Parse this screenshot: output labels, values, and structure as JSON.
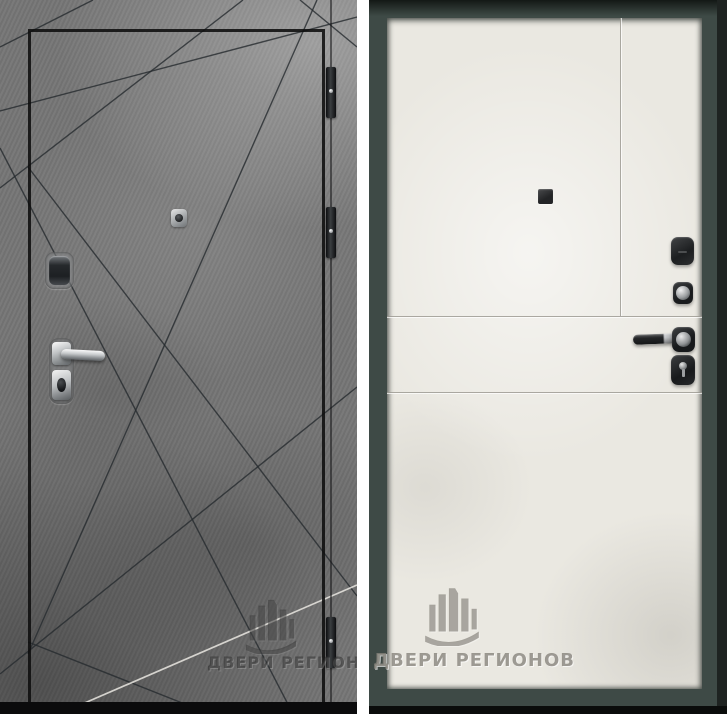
{
  "image": {
    "type": "product-photo",
    "subject": "steel entrance door, exterior and interior sides shown side by side"
  },
  "watermark": {
    "brand_text": "ДВЕРИ РЕГИОНОВ",
    "logo": "buildings-with-arc-logo"
  },
  "panels": {
    "left": {
      "name": "door-exterior-side",
      "finish": "gray concrete with diagonal ray grooves",
      "watermark_text": "ДВЕРИ РЕГИОНОВ",
      "hardware": [
        "peephole",
        "lock-cover",
        "lever-handle",
        "cylinder-lock",
        "hinge",
        "hinge",
        "hinge"
      ]
    },
    "right": {
      "name": "door-interior-side",
      "finish": "off-white panel with horizontal and vertical grooves, dark slate frame",
      "watermark_text": "ДВЕРИ РЕГИОНОВ",
      "hardware": [
        "peephole",
        "lock-cover",
        "turn-knob",
        "lever-handle",
        "keyhole-escutcheon"
      ]
    }
  },
  "colors": {
    "concrete_gray": "#757575",
    "groove_dark": "#2b2f33",
    "panel_offwhite": "#eae8e1",
    "frame_slate": "#3e4a46",
    "hardware_chrome": "#c6c9cb",
    "hardware_dark": "#1c1e20",
    "divider_white": "#ffffff"
  }
}
